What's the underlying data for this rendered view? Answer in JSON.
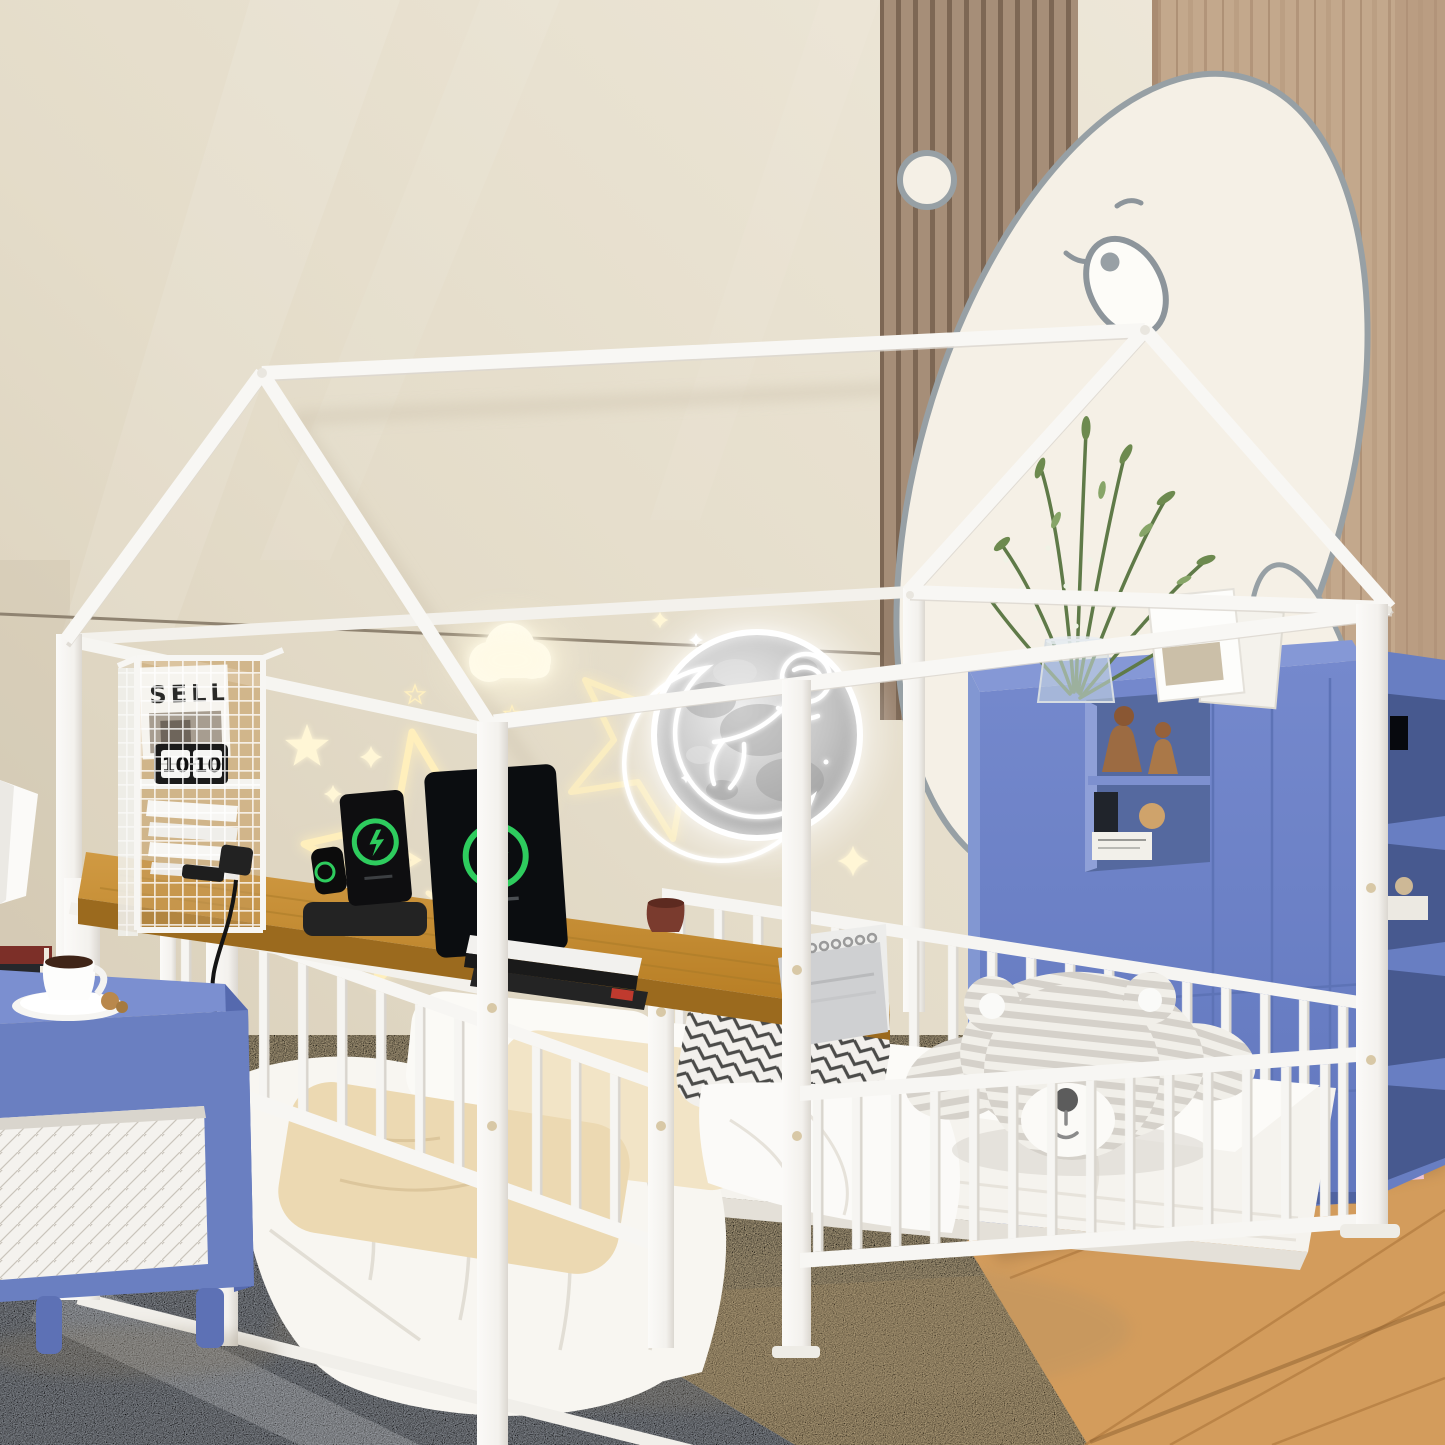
{
  "scene": {
    "type": "product-photo",
    "room": "kids-bedroom-with-house-bed",
    "flip_clock": {
      "hours": "10",
      "minutes": "10"
    },
    "magazine": {
      "title": "SELL"
    },
    "colors": {
      "wall_beige": "#e7dfd0",
      "frame_white": "#f8f7f4",
      "desk_wood": "#c58a33",
      "cabinet_blue": "#6d83c6",
      "nightstand_blue": "#6a7fc1",
      "rug_gray": "#b5bbc4",
      "carpet_beige": "#e8d4ab",
      "wood_floor": "#d39c5c",
      "wood_slat_panel": "#a68d77",
      "bear_outline": "#97a0a5",
      "neon_warm": "#fff1c2",
      "neon_white": "#ffffff",
      "charge_green": "#2ecc5e"
    }
  }
}
